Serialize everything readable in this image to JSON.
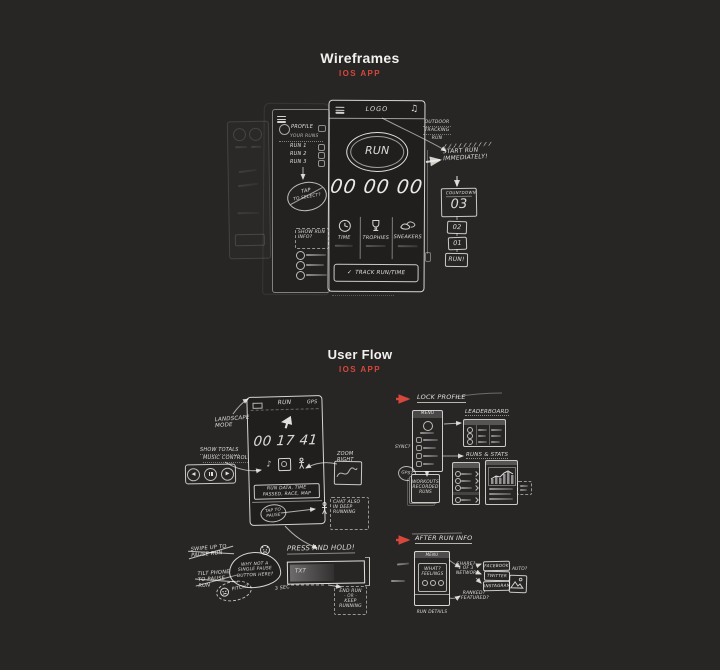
{
  "page": {
    "background": "#282525",
    "accent": "#d6473c"
  },
  "wireframes_section": {
    "title": "Wireframes",
    "subtitle": "IOS APP",
    "menu_screen": {
      "profile": "PROFILE",
      "runs_caption": "YOUR RUNS",
      "items": [
        "RUN 1",
        "RUN 2",
        "RUN 3"
      ],
      "select_line1": "TAP",
      "select_line2": "TO SELECT?"
    },
    "main_screen": {
      "logo": "LOGO",
      "run_button": "RUN",
      "digits": "00 00 00",
      "tabs": [
        "TIME",
        "TROPHIES",
        "SNEAKERS"
      ],
      "bottom_check": "✓",
      "bottom_bar": "TRACK RUN/TIME"
    },
    "notes": {
      "outdoor": [
        "OUTDOOR",
        "TRACKING",
        "RUN"
      ],
      "start": "START RUN IMMEDIATELY!",
      "countdown_label": "COUNTDOWN",
      "countdown_value": "03",
      "count_boxes": [
        "02",
        "01",
        "RUN!"
      ],
      "info_note": "SHOW RUN INFO?"
    }
  },
  "userflow_section": {
    "title": "User Flow",
    "subtitle": "IOS APP",
    "run_screen": {
      "title": "RUN",
      "gps": "GPS",
      "timer": "00 17 41",
      "data_bar": "RUN DATA, TIME PASSED, RACE, MAP",
      "pause_bubble": "TAP TO PAUSE",
      "landscape_note": "LANDSCAPE MODE",
      "totals_note_1": "SHOW TOTALS",
      "totals_note_2": "MUSIC CONTROL",
      "zoom_note": "ZOOM RIGHT",
      "chat_note": "CHAT ALSO IN DEEP RUNNING"
    },
    "profile_flow": {
      "title": "LOCK PROFILE",
      "menu_header": "MENU",
      "leaderboard_title": "LEADERBOARD",
      "runs_stats_title": "RUNS & STATS",
      "sync_note": "SYNC?",
      "gps_bubble": "GPS?",
      "cards_note": "WORKOUTS RECORDED RUNS"
    },
    "pause_flow": {
      "crossed_1": "SWIPE UP TO PAUSE RUN",
      "crossed_2": "TILT PHONE TO PAUSE RUN",
      "bubble": "WHY NOT A SINGLE PAUSE BUTTON HERE?",
      "pitch": "PITCH?",
      "title": "PRESS AND HOLD!",
      "bar_label": "TXT",
      "duration": "3 SEC",
      "end_note": [
        "END RUN",
        "- OR -",
        "KEEP RUNNING"
      ]
    },
    "after_flow": {
      "title": "AFTER RUN INFO",
      "menu_header": "MENU",
      "what_line1": "WHAT?",
      "what_line2": "FEELINGS",
      "details": "RUN DETAILS",
      "share_note": [
        "SHARE?",
        "1 OF 3",
        "NETWORK"
      ],
      "networks": [
        "FACEBOOK",
        "TWITTER",
        "INSTAGRAM"
      ],
      "auto_note": "AUTO?",
      "featured_note": [
        "RANKED?",
        "FEATURED?"
      ]
    }
  }
}
